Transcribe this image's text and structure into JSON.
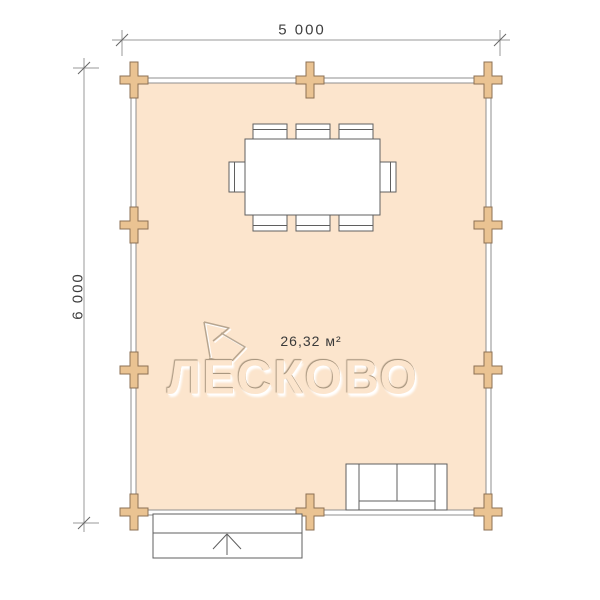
{
  "plan": {
    "dimensions": {
      "width_label": "5 000",
      "height_label": "6 000"
    },
    "room": {
      "area_label": "26,32 м²"
    },
    "watermark": {
      "brand": "ЛЕСКОВО",
      "shadow": "#a79680",
      "highlight": "#ffffff"
    },
    "colors": {
      "room_fill": "#fce5cd",
      "wall_fill": "#ffffff",
      "wall_stroke": "#8f8f8f",
      "joint_fill": "#eac392",
      "joint_stroke": "#8c7054",
      "furniture_fill": "#ffffff",
      "furniture_stroke": "#5f5f5f",
      "dimension_stroke": "#9a9a9a",
      "tick_stroke": "#666666"
    }
  }
}
